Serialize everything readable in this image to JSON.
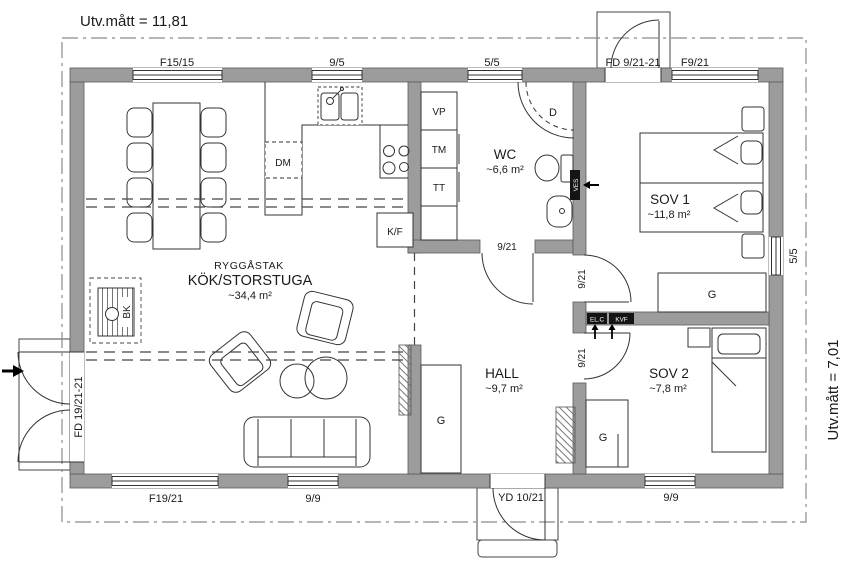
{
  "drawing": {
    "dim_top": "Utv.mått = 11,81",
    "dim_right": "Utv.mått = 7,01"
  },
  "rooms": {
    "main": {
      "roof": "RYGGÅSTAK",
      "name": "KÖK/STORSTUGA",
      "area": "~34,4 m²"
    },
    "wc": {
      "name": "WC",
      "area": "~6,6 m²"
    },
    "hall": {
      "name": "HALL",
      "area": "~9,7 m²"
    },
    "sov1": {
      "name": "SOV 1",
      "area": "~11,8 m²"
    },
    "sov2": {
      "name": "SOV 2",
      "area": "~7,8 m²"
    }
  },
  "windows": {
    "f15": "F15/15",
    "w95": "9/5",
    "w55_top": "5/5",
    "f921": "F9/21",
    "w55_side": "5/5",
    "f1921": "F19/21",
    "w99_living": "9/9",
    "w99_sov2": "9/9"
  },
  "doors": {
    "entry_top": "FD 9/21-21",
    "entry_left": "FD 19/21-21",
    "entry_hall": "YD 10/21",
    "wc": "9/21",
    "sov1": "9/21",
    "sov2": "9/21"
  },
  "fixtures": {
    "dishwasher": "DM",
    "fridge_freezer": "K/F",
    "water_heater": "VP",
    "washing_machine": "TM",
    "dryer": "TT",
    "shower": "D",
    "fireplace": "BK",
    "ves": "VES",
    "el_central": "EL.C",
    "kvf": "KVF",
    "wardrobe": "G"
  },
  "colors": {
    "wall_fill": "#9c9c9c",
    "line": "#333333",
    "background": "#ffffff"
  }
}
